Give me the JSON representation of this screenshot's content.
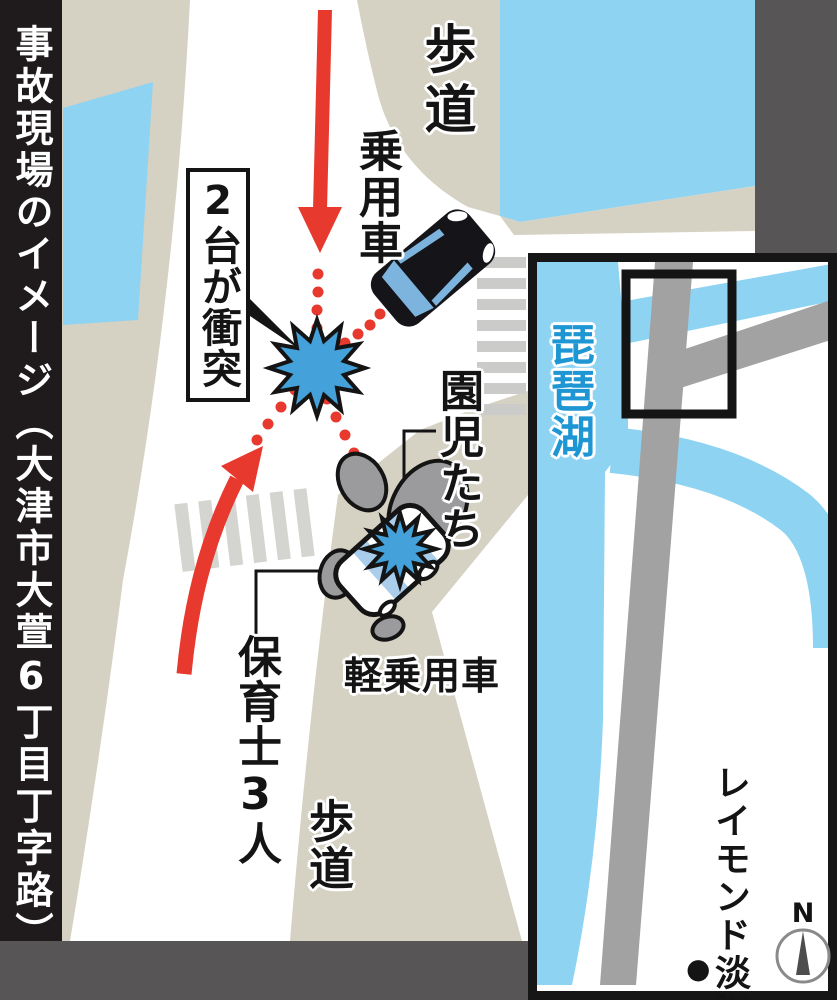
{
  "title": "事故現場のイメージ（大津市大萱6丁目丁字路）",
  "map": {
    "sidewalk_top": "歩道",
    "passenger_car": "乗用車",
    "collision_note": "2台が衝突",
    "children": "園児たち",
    "kei_car": "軽乗用車",
    "teachers": "保育士3人",
    "sidewalk_bottom": "歩道"
  },
  "inset": {
    "lake": "琵琶湖",
    "nursery": "レイモンド淡海保育園",
    "marker": "●",
    "compass_north": "N"
  },
  "colors": {
    "red": "#e8392e",
    "beige": "#d5d1c3",
    "light_blue": "#8ed3f2",
    "window_blue": "#7db4de",
    "stripe_blue": "#a9cdea",
    "burst_blue": "#45a1d9",
    "road_gray": "#a3a2a3",
    "crosswalk_gray": "#cbcbc9",
    "crosswalk_light": "#d4d4d1",
    "dark_gray": "#575556",
    "bar_black": "#1f1b1c",
    "blob_gray": "#9b9b9d",
    "ink": "#141414",
    "lake_text": "#1e96d4"
  }
}
